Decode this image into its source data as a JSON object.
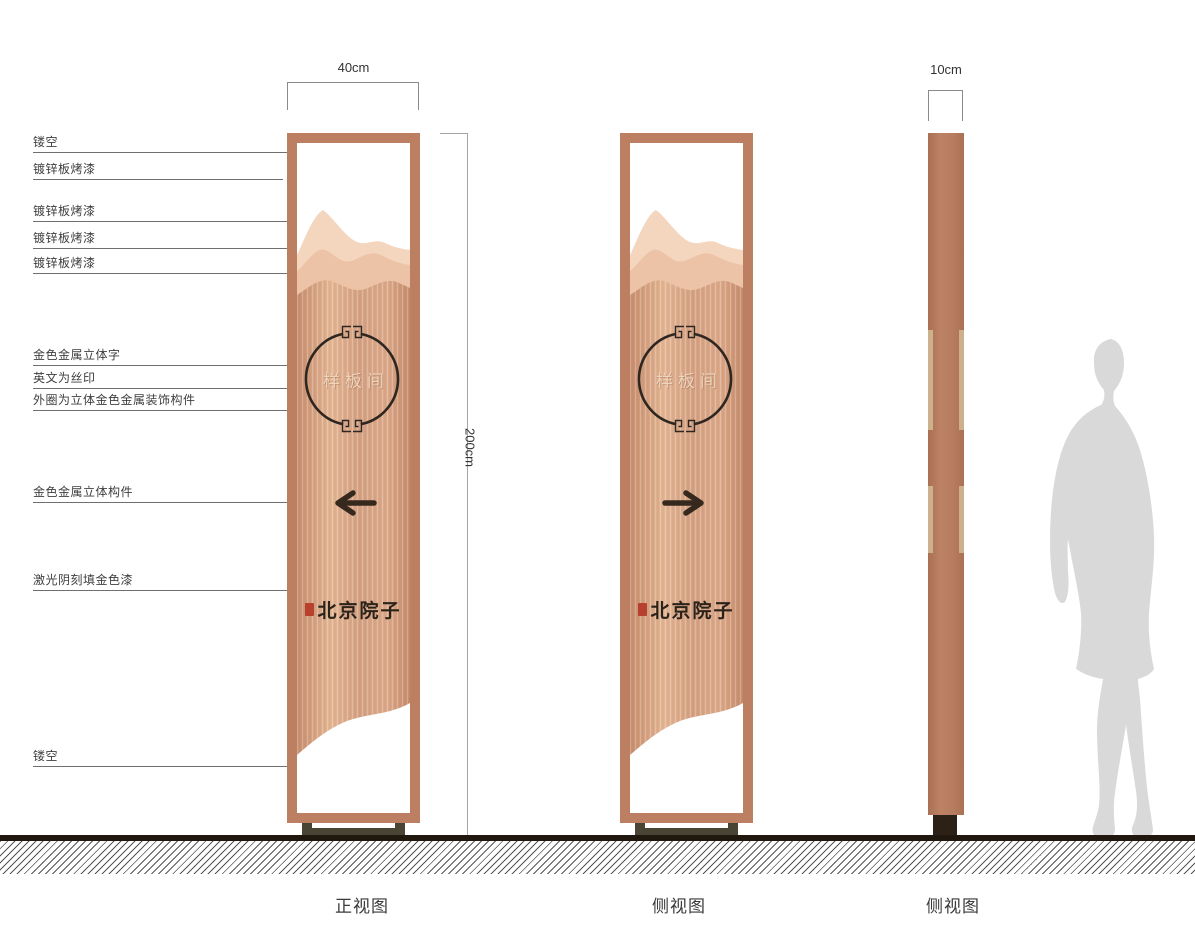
{
  "annotations": [
    {
      "label": "镂空"
    },
    {
      "label": "镀锌板烤漆"
    },
    {
      "label": "镀锌板烤漆"
    },
    {
      "label": "镀锌板烤漆"
    },
    {
      "label": "镀锌板烤漆"
    },
    {
      "label": "金色金属立体字"
    },
    {
      "label": "英文为丝印"
    },
    {
      "label": "外圈为立体金色金属装饰构件"
    },
    {
      "label": "金色金属立体构件"
    },
    {
      "label": "激光阴刻填金色漆"
    },
    {
      "label": "镂空"
    }
  ],
  "dimensions": {
    "front_width": "40cm",
    "height": "200cm",
    "side_depth": "10cm"
  },
  "signs": {
    "front": {
      "circle_text": "样板间",
      "logo_text": "北京院子",
      "arrow_icon": "arrow-left-icon"
    },
    "back": {
      "circle_text": "样板间",
      "logo_text": "北京院子",
      "arrow_icon": "arrow-right-icon"
    }
  },
  "views": [
    {
      "label": "正视图"
    },
    {
      "label": "侧视图"
    },
    {
      "label": "侧视图"
    }
  ],
  "colors": {
    "frame_copper": "#bc7f62",
    "panel_copper_light": "#e4b795",
    "panel_copper_dark": "#c68c6d",
    "mountain_back": "#f4d6bf",
    "mountain_mid": "#ecc3a6",
    "ink_dark": "#2e2620",
    "seal_red": "#b8412e",
    "base_olive": "#4a4435",
    "pillar_strip_tan": "#cdb18d",
    "silhouette_gray": "#d9d9d9",
    "ground_dark": "#20180f"
  }
}
